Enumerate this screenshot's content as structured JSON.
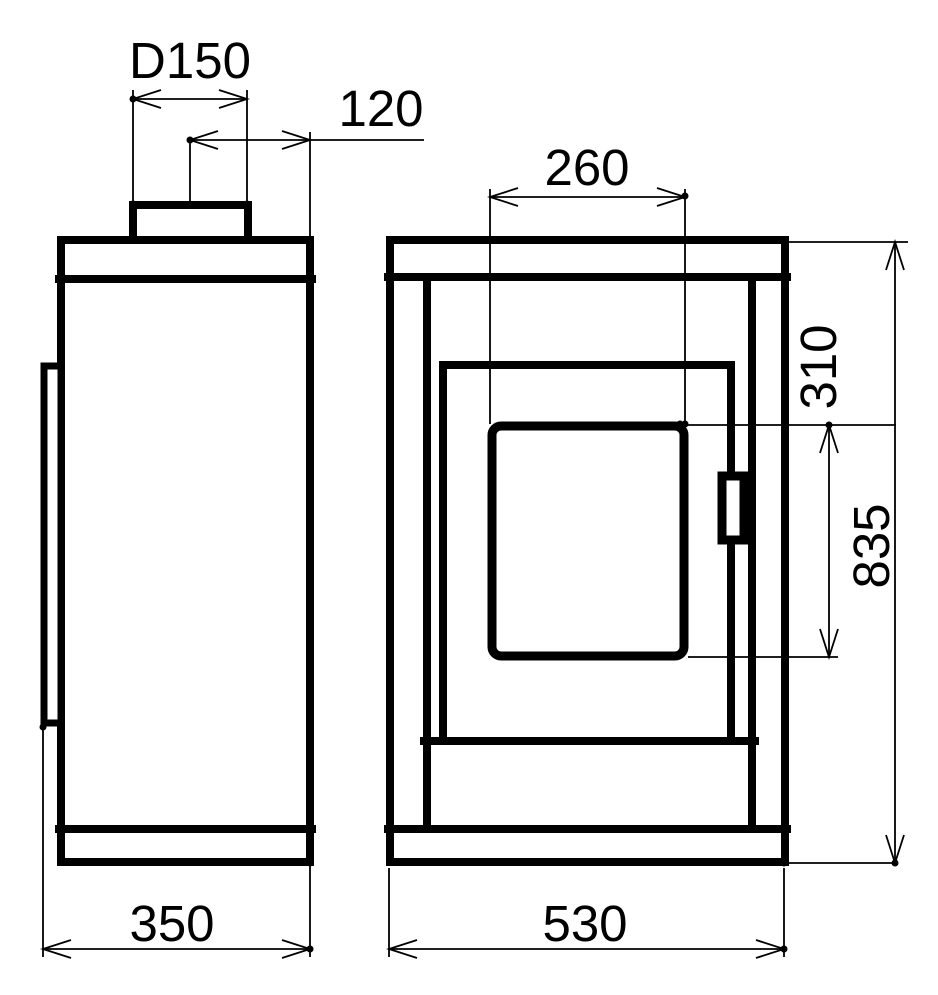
{
  "drawing": {
    "background_color": "#ffffff",
    "line_color": "#000000",
    "views": {
      "side_view": "side view",
      "front_view": "front view"
    },
    "dimensions": {
      "flue_diameter": "D150",
      "flue_center_offset": "120",
      "glass_width": "260",
      "glass_height": "310",
      "overall_height": "835",
      "depth": "350",
      "width": "530"
    }
  }
}
